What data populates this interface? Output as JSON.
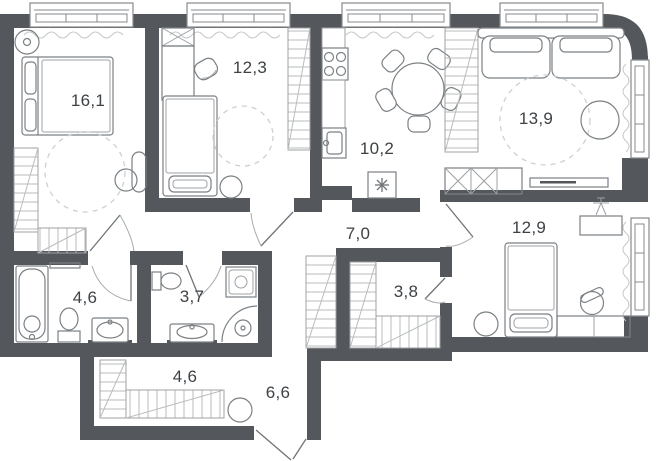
{
  "plan": {
    "title": "apartment-floor-plan",
    "rooms": [
      {
        "id": "bedroom-1",
        "area": "16,1"
      },
      {
        "id": "bedroom-2",
        "area": "12,3"
      },
      {
        "id": "kitchen",
        "area": "10,2"
      },
      {
        "id": "living-room",
        "area": "13,9"
      },
      {
        "id": "hallway",
        "area": "7,0"
      },
      {
        "id": "bedroom-3",
        "area": "12,9"
      },
      {
        "id": "bathroom",
        "area": "4,6"
      },
      {
        "id": "toilet",
        "area": "3,7"
      },
      {
        "id": "walk-in-wardrobe",
        "area": "3,8"
      },
      {
        "id": "hall-wardrobe",
        "area": "4,6"
      },
      {
        "id": "entrance-hall",
        "area": "6,6"
      }
    ],
    "colors": {
      "wall": "#54585c",
      "furniture_stroke": "#7b8084",
      "hatch": "#b9bcbe",
      "label": "#3d4246",
      "background": "#ffffff"
    }
  }
}
